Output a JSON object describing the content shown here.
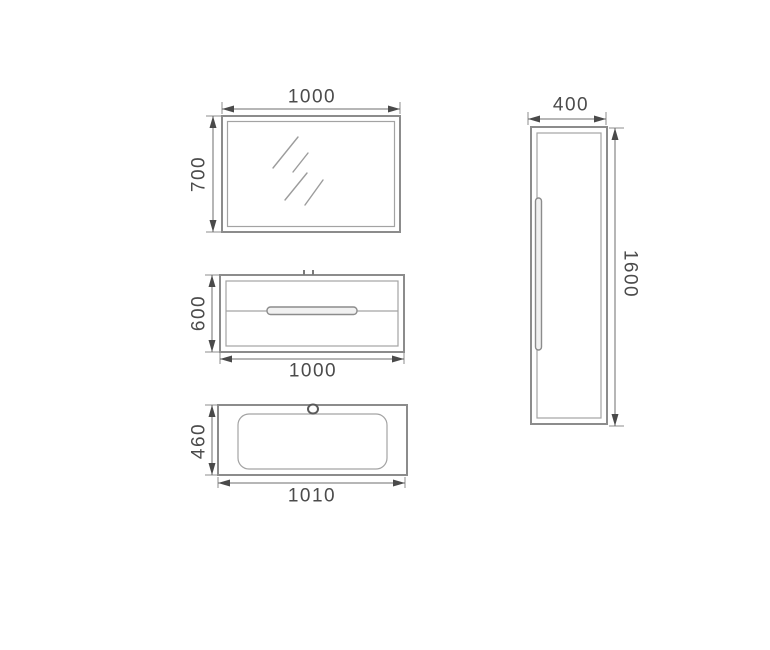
{
  "drawing": {
    "background_color": "#ffffff",
    "outline_color": "#8c8c8c",
    "dimension_color": "#6e6e6e",
    "text_color": "#4b4b4b",
    "mirror": {
      "width_label": "1000",
      "height_label": "700"
    },
    "vanity_cabinet": {
      "width_label": "1000",
      "height_label": "600"
    },
    "basin": {
      "width_label": "1010",
      "depth_label": "460"
    },
    "side_cabinet": {
      "width_label": "400",
      "height_label": "1600"
    }
  }
}
